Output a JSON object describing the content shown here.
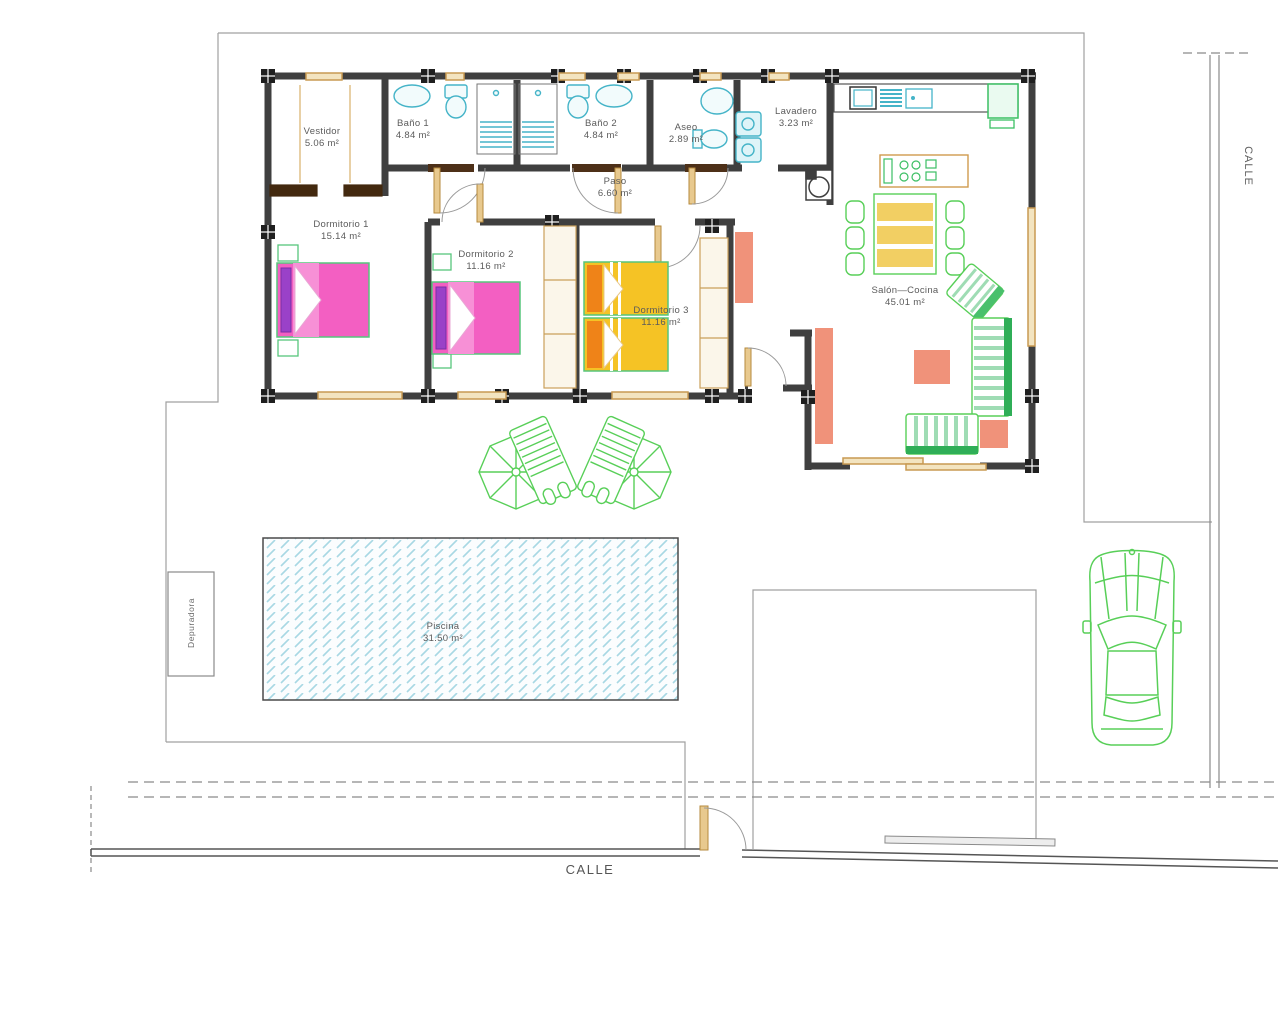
{
  "plan_type": "house floor plan with plot, pool and street",
  "rooms": [
    {
      "name": "Vestidor",
      "area": "5.06 m²"
    },
    {
      "name": "Baño 1",
      "area": "4.84 m²"
    },
    {
      "name": "Baño 2",
      "area": "4.84 m²"
    },
    {
      "name": "Aseo",
      "area": "2.89 m²"
    },
    {
      "name": "Lavadero",
      "area": "3.23 m²"
    },
    {
      "name": "Paso",
      "area": "6.60 m²"
    },
    {
      "name": "Dormitorio 1",
      "area": "15.14 m²"
    },
    {
      "name": "Dormitorio 2",
      "area": "11.16 m²"
    },
    {
      "name": "Dormitorio 3",
      "area": "11.16 m²"
    },
    {
      "name": "Salón—Cocina",
      "area": "45.01 m²"
    },
    {
      "name": "Piscina",
      "area": "31.50 m²"
    }
  ],
  "annotations": {
    "depuradora": "Depuradora",
    "street_right": "CALLE",
    "street_bottom": "CALLE"
  },
  "colors": {
    "wall": "#3f3f3f",
    "boundary": "#a0a0a0",
    "window_wood": "#c89a52",
    "fixture_cyan": "#45b4c8",
    "furniture_green": "#58cf58",
    "sofa_green": "#2fae57",
    "bed_pink": "#f35fc2",
    "pillow_purple": "#9a41c8",
    "bed_yellow": "#f5c325",
    "pillow_orange": "#ef8318",
    "accent_salmon": "#f0927a",
    "pool_blue": "#a8d8e4",
    "table_yellow": "#f2cf63"
  }
}
